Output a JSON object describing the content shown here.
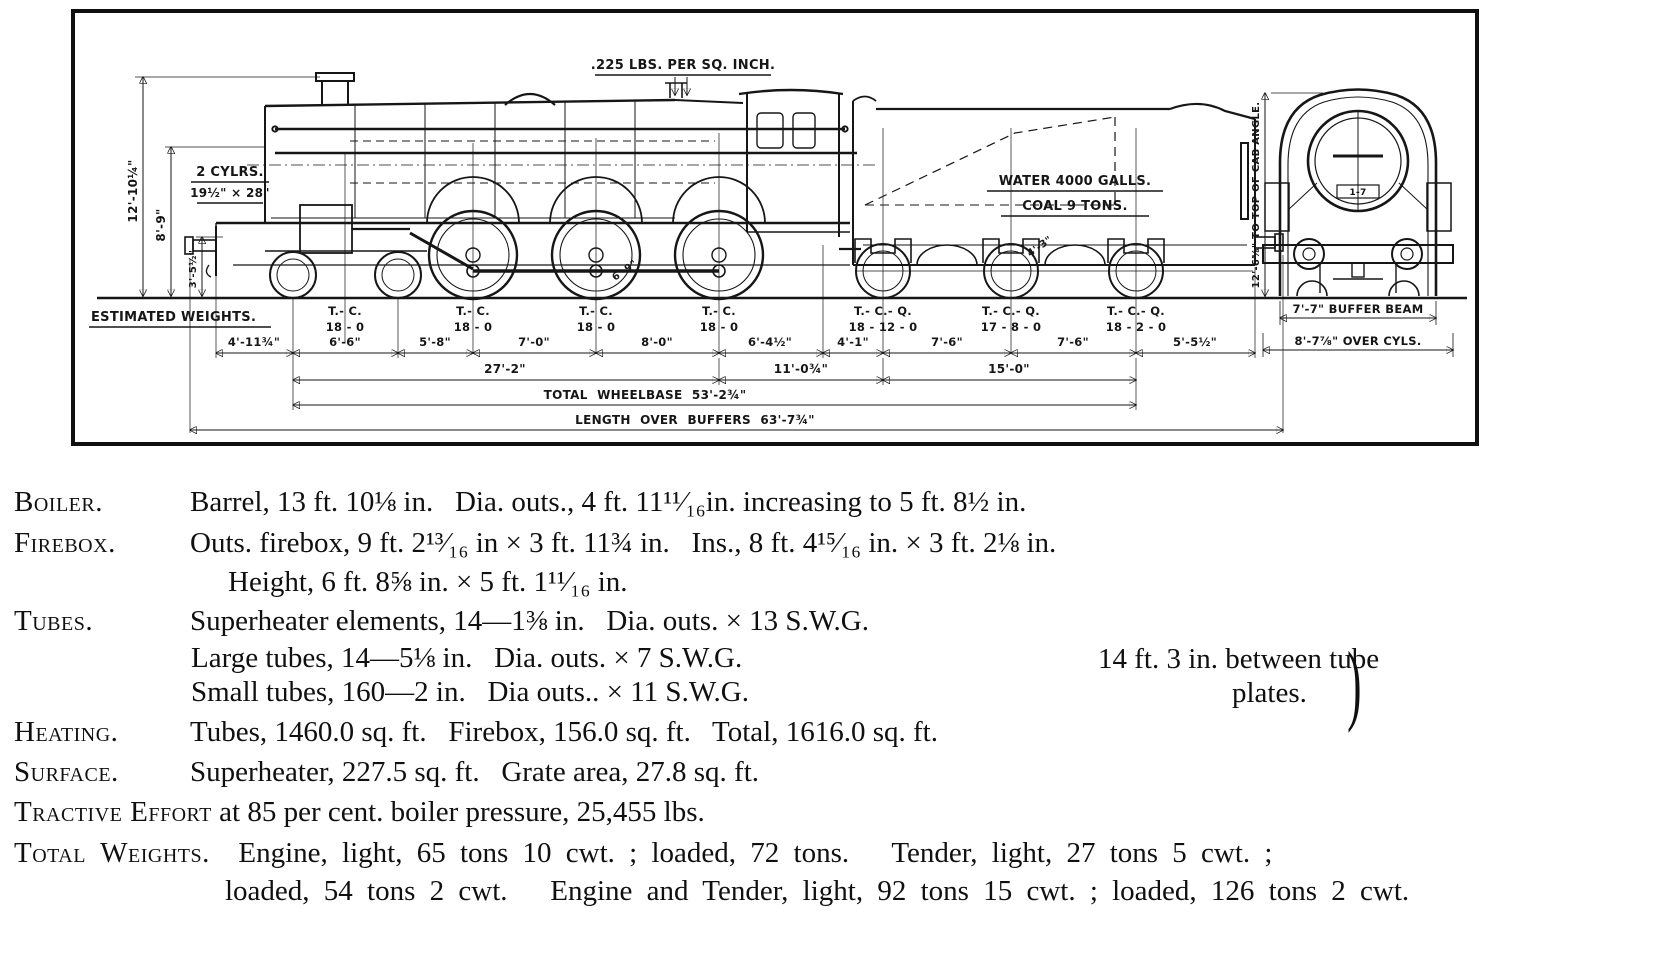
{
  "diagram": {
    "pressure_label": ".225 LBS. PER SQ. INCH.",
    "cylinders": {
      "line1": "2 CYLRS.",
      "line2": "19½\" × 28\""
    },
    "tender_lettering": {
      "water": "WATER 4000 GALLS.",
      "coal": "COAL 9 TONS."
    },
    "left_dims": {
      "to_top_of_chimney": "12'-10¼\"",
      "to_boiler_centre": "8'-9\"",
      "buffer_height": "3'-5½\""
    },
    "front_view": {
      "cab_height": "12'-6⅝\" TO TOP OF CAB ANGLE.",
      "buffer_beam": "7'-7\" BUFFER BEAM",
      "over_cylinders": "8'-7⅞\" OVER CYLS.",
      "plate": "1-7"
    },
    "estimated_weights_heading": "ESTIMATED WEIGHTS.",
    "wheel_labels": {
      "driver_diameter": "6'-9\"",
      "tender_wheel": "4'-3\""
    },
    "engine_axles": [
      {
        "unit": "T.- C.",
        "weight": "18 - 0"
      },
      {
        "unit": "T.- C.",
        "weight": "18 - 0"
      },
      {
        "unit": "T.- C.",
        "weight": "18 - 0"
      },
      {
        "unit": "T.- C.",
        "weight": "18 - 0"
      }
    ],
    "tender_axles": [
      {
        "unit": "T.- C.- Q.",
        "weight": "18 - 12 - 0"
      },
      {
        "unit": "T.- C.- Q.",
        "weight": "17 - 8 - 0"
      },
      {
        "unit": "T.- C.- Q.",
        "weight": "18 - 2 - 0"
      }
    ],
    "axle_spacings": [
      "4'-11¾\"",
      "6'-6\"",
      "5'-8\"",
      "7'-0\"",
      "8'-0\"",
      "6'-4½\"",
      "4'-1\"",
      "7'-6\"",
      "7'-6\"",
      "5'-5½\""
    ],
    "group_dims": [
      "27'-2\"",
      "11'-0¾\"",
      "15'-0\""
    ],
    "total_wheelbase": "TOTAL WHEELBASE 53'-2¾\"",
    "length_over_buffers": "LENGTH OVER BUFFERS 63'-7¾\""
  },
  "specs": {
    "rows": [
      {
        "term": "Boiler.",
        "text": "Barrel, 13 ft. 10⅛ in.   Dia. outs., 4 ft. 11¹¹⁄₁₆in. increasing to 5 ft. 8½ in."
      },
      {
        "term": "Firebox.",
        "text": "Outs. firebox, 9 ft. 2¹³⁄₁₆ in × 3 ft. 11¾ in.   Ins., 8 ft. 4¹⁵⁄₁₆ in. × 3 ft. 2⅛ in."
      },
      {
        "term": "",
        "text": "Height, 6 ft. 8⅝ in. × 5 ft. 1¹¹⁄₁₆ in."
      },
      {
        "term": "Tubes.",
        "text": "Superheater elements, 14—1⅜ in.   Dia. outs. × 13 S.W.G."
      },
      {
        "term": "",
        "text": "Large tubes, 14—5⅛ in.   Dia. outs. × 7 S.W.G."
      },
      {
        "term": "",
        "text": "Small tubes, 160—2 in.   Dia outs.. × 11 S.W.G."
      },
      {
        "term": "Heating.",
        "text": "Tubes, 1460.0 sq. ft.   Firebox, 156.0 sq. ft.   Total, 1616.0 sq. ft."
      },
      {
        "term": "Surface.",
        "text": "Superheater, 227.5 sq. ft.   Grate area, 27.8 sq. ft."
      }
    ],
    "tube_plates_note": {
      "line1": "14 ft. 3 in. between tube",
      "line2": "plates.",
      "brace": ")"
    },
    "tractive_effort": {
      "term": "Tractive Effort",
      "rest": " at 85 per cent. boiler pressure, 25,455 lbs."
    },
    "total_weights": {
      "term": "Total Weights.",
      "line1": "  Engine, light, 65 tons 10 cwt. ; loaded, 72 tons.   Tender, light, 27 tons 5 cwt. ;",
      "line2": "loaded, 54 tons 2 cwt.   Engine and Tender, light, 92 tons 15 cwt. ; loaded, 126 tons 2 cwt."
    }
  }
}
